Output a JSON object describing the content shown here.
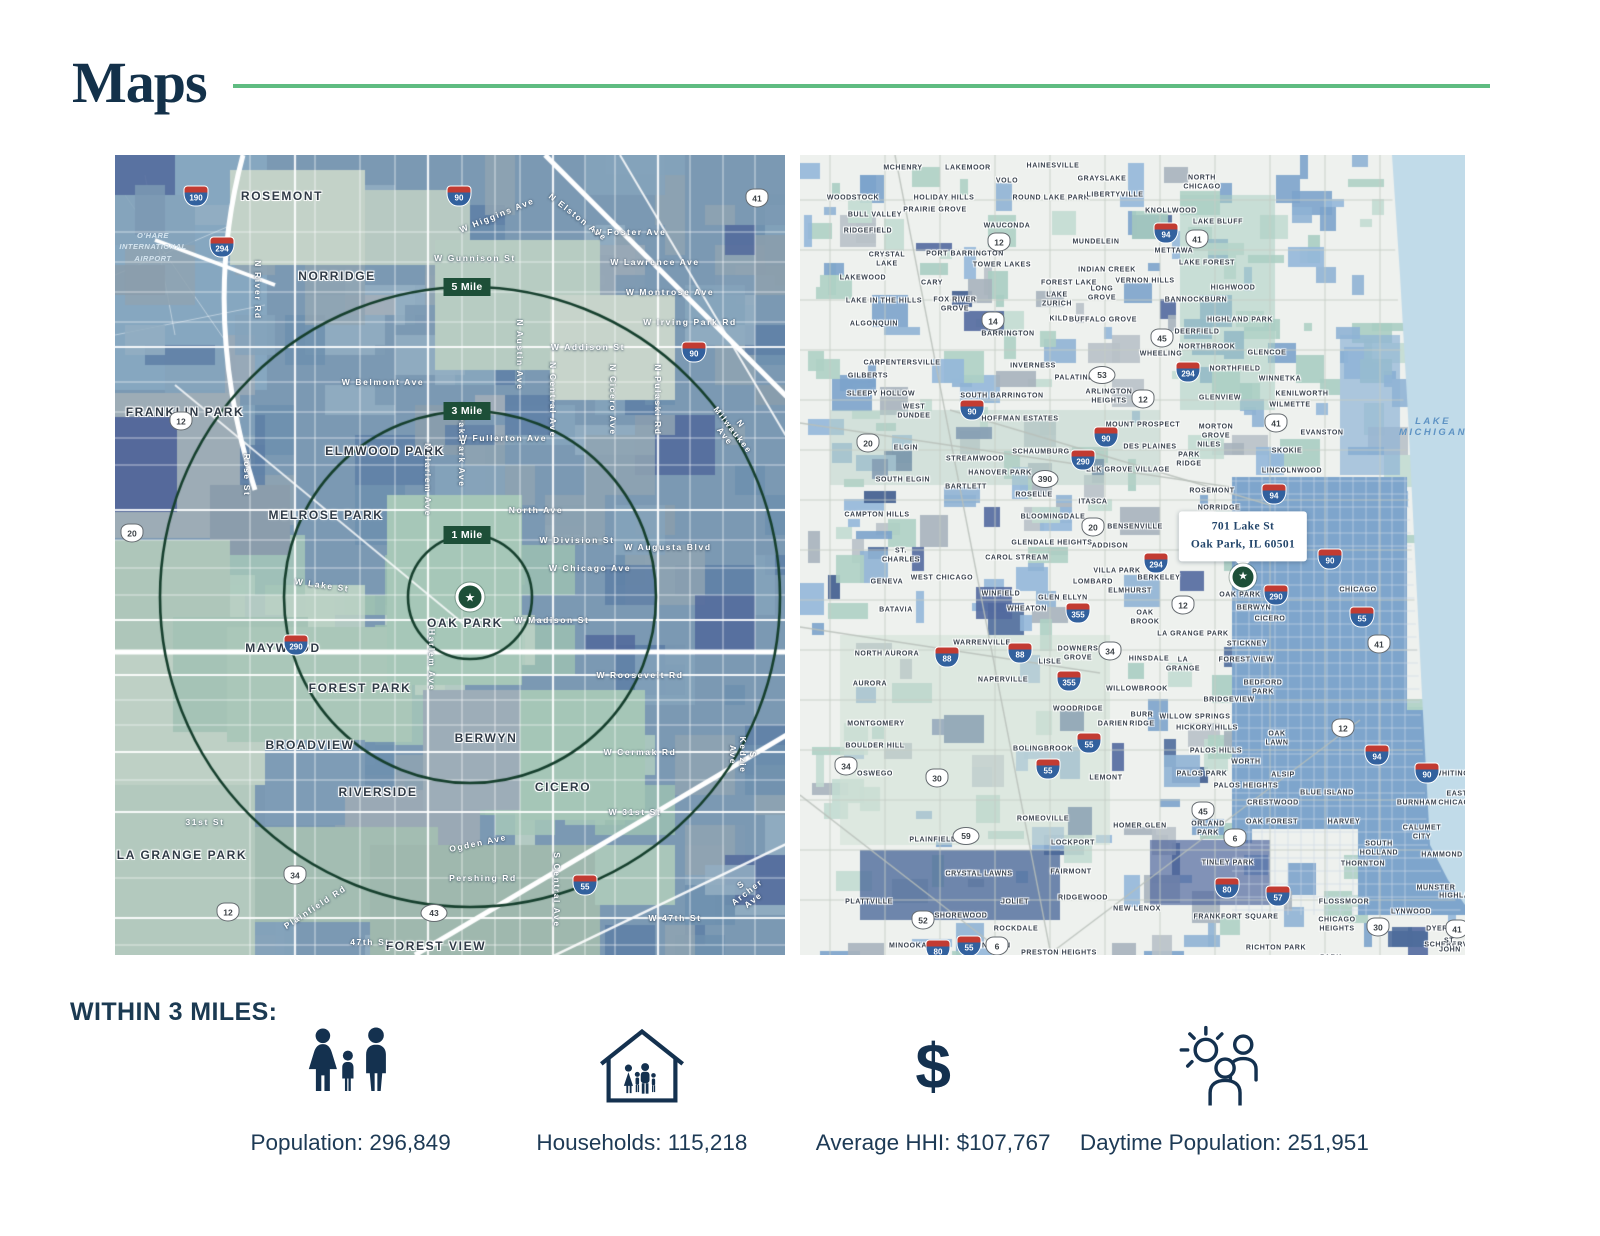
{
  "header": {
    "title": "Maps"
  },
  "icons": {
    "star": "★",
    "dollar": "$"
  },
  "colors": {
    "accent_green": "#5fbc81",
    "navy": "#14314f",
    "ring_green": "#16402e",
    "badge_green": "#1d4f38",
    "lake_blue": "#c1dbe9"
  },
  "left_map": {
    "ring_center": {
      "x": 355,
      "y": 442
    },
    "rings": [
      {
        "label": "1 Mile",
        "radius": 62
      },
      {
        "label": "3 Mile",
        "radius": 186
      },
      {
        "label": "5 Mile",
        "radius": 310
      }
    ],
    "airport_label": "O'HARE\nINTERNATIONAL\nAIRPORT",
    "airport_pos": {
      "x": 38,
      "y": 92
    },
    "cities": [
      [
        "ROSEMONT",
        167,
        41
      ],
      [
        "NORRIDGE",
        222,
        121
      ],
      [
        "FRANKLIN PARK",
        70,
        257
      ],
      [
        "ELMWOOD PARK",
        270,
        296
      ],
      [
        "MELROSE PARK",
        211,
        360
      ],
      [
        "MAYWOOD",
        168,
        493
      ],
      [
        "FOREST PARK",
        245,
        533
      ],
      [
        "BROADVIEW",
        195,
        590
      ],
      [
        "RIVERSIDE",
        263,
        637
      ],
      [
        "LA GRANGE PARK",
        67,
        700
      ],
      [
        "BERWYN",
        371,
        583
      ],
      [
        "CICERO",
        448,
        632
      ],
      [
        "FOREST VIEW",
        321,
        791
      ],
      [
        "OAK PARK",
        350,
        468
      ]
    ],
    "streets": [
      [
        "W Gunnison St",
        360,
        103,
        0
      ],
      [
        "W Foster Ave",
        515,
        77,
        0
      ],
      [
        "W Lawrence Ave",
        540,
        107,
        0
      ],
      [
        "W Montrose Ave",
        555,
        137,
        0
      ],
      [
        "W Irving Park Rd",
        575,
        167,
        0
      ],
      [
        "W Addison St",
        473,
        192,
        0
      ],
      [
        "W Belmont Ave",
        268,
        227,
        0
      ],
      [
        "W Fullerton Ave",
        388,
        283,
        0
      ],
      [
        "North Ave",
        421,
        355,
        0
      ],
      [
        "W Division St",
        462,
        385,
        0
      ],
      [
        "W Chicago Ave",
        475,
        413,
        0
      ],
      [
        "W Augusta Blvd",
        553,
        392,
        0
      ],
      [
        "W Madison St",
        437,
        465,
        0
      ],
      [
        "W Roosevelt Rd",
        525,
        520,
        0
      ],
      [
        "W Cermak Rd",
        525,
        597,
        0
      ],
      [
        "W 31st St",
        520,
        657,
        0
      ],
      [
        "W 47th St",
        560,
        763,
        0
      ],
      [
        "31st St",
        90,
        667,
        0
      ],
      [
        "Ogden Ave",
        363,
        688,
        -12
      ],
      [
        "Pershing Rd",
        368,
        723,
        0
      ],
      [
        "Plainfield Rd",
        200,
        752,
        -33
      ],
      [
        "47th St",
        255,
        787,
        0
      ],
      [
        "W Lake St",
        207,
        430,
        8
      ],
      [
        "N River Rd",
        143,
        135,
        90
      ],
      [
        "Rose St",
        132,
        320,
        90
      ],
      [
        "N Harlem Ave",
        313,
        325,
        90
      ],
      [
        "N Oak Park Ave",
        347,
        290,
        90
      ],
      [
        "N Austin Ave",
        405,
        200,
        90
      ],
      [
        "N Central Ave",
        438,
        245,
        90
      ],
      [
        "N Cicero Ave",
        498,
        245,
        90
      ],
      [
        "N Pulaski Rd",
        543,
        245,
        90
      ],
      [
        "N Milwaukee Ave",
        618,
        275,
        52
      ],
      [
        "Harlem Ave",
        317,
        505,
        90
      ],
      [
        "S Central Ave",
        442,
        735,
        90
      ],
      [
        "S Kedzie Ave",
        628,
        600,
        90
      ],
      [
        "S Archer Ave",
        632,
        737,
        -38
      ],
      [
        "W Higgins Ave",
        382,
        60,
        -22
      ],
      [
        "N Elston Ave",
        463,
        62,
        38
      ]
    ],
    "shields": [
      [
        "i",
        "190",
        81,
        41
      ],
      [
        "i",
        "90",
        344,
        41
      ],
      [
        "i",
        "294",
        107,
        92
      ],
      [
        "i",
        "90",
        579,
        197
      ],
      [
        "u",
        "12",
        66,
        266
      ],
      [
        "u",
        "20",
        17,
        378
      ],
      [
        "u",
        "41",
        642,
        43
      ],
      [
        "i",
        "290",
        181,
        490
      ],
      [
        "u",
        "34",
        180,
        720
      ],
      [
        "u",
        "12",
        113,
        757
      ],
      [
        "o",
        "43",
        319,
        758
      ],
      [
        "i",
        "55",
        470,
        730
      ]
    ]
  },
  "right_map": {
    "callout": {
      "line1": "701 Lake St",
      "line2": "Oak Park, IL 60501",
      "x": 443,
      "y": 406
    },
    "star": {
      "x": 443,
      "y": 422
    },
    "water_label": {
      "t": "LAKE MICHIGAN",
      "x": 633,
      "y": 272
    },
    "cities": [
      [
        "MCHENRY",
        103,
        13
      ],
      [
        "LAKEMOOR",
        168,
        13
      ],
      [
        "VOLO",
        207,
        26
      ],
      [
        "HAINESVILLE",
        253,
        11
      ],
      [
        "GRAYSLAKE",
        302,
        24
      ],
      [
        "NORTH\nCHICAGO",
        402,
        28
      ],
      [
        "WOODSTOCK",
        53,
        43
      ],
      [
        "HOLIDAY HILLS",
        144,
        43
      ],
      [
        "ROUND LAKE PARK",
        251,
        43
      ],
      [
        "LIBERTYVILLE",
        315,
        40
      ],
      [
        "BULL VALLEY",
        75,
        60
      ],
      [
        "PRAIRIE GROVE",
        135,
        55
      ],
      [
        "KNOLLWOOD",
        371,
        56
      ],
      [
        "RIDGEFIELD",
        68,
        76
      ],
      [
        "WAUCONDA",
        207,
        71
      ],
      [
        "LAKE BLUFF",
        418,
        67
      ],
      [
        "CRYSTAL\nLAKE",
        87,
        105
      ],
      [
        "PORT BARRINGTON",
        165,
        99
      ],
      [
        "MUNDELEIN",
        296,
        87
      ],
      [
        "METTAWA",
        374,
        96
      ],
      [
        "TOWER LAKES",
        202,
        110
      ],
      [
        "INDIAN CREEK",
        307,
        115
      ],
      [
        "LAKE FOREST",
        407,
        108
      ],
      [
        "LAKEWOOD",
        63,
        123
      ],
      [
        "CARY",
        132,
        128
      ],
      [
        "FOREST LAKE",
        269,
        128
      ],
      [
        "VERNON HILLS",
        345,
        126
      ],
      [
        "LONG\nGROVE",
        302,
        139
      ],
      [
        "HIGHWOOD",
        433,
        133
      ],
      [
        "LAKE IN THE HILLS",
        84,
        146
      ],
      [
        "FOX RIVER\nGROVE",
        155,
        150
      ],
      [
        "LAKE\nZURICH",
        257,
        145
      ],
      [
        "BANNOCKBURN",
        396,
        145
      ],
      [
        "ALGONQUIN",
        74,
        169
      ],
      [
        "KILDEER",
        267,
        164
      ],
      [
        "BUFFALO GROVE",
        303,
        165
      ],
      [
        "HIGHLAND PARK",
        440,
        165
      ],
      [
        "BARRINGTON",
        208,
        179
      ],
      [
        "DEERFIELD",
        397,
        177
      ],
      [
        "CARPENTERSVILLE",
        102,
        208
      ],
      [
        "NORTHBROOK",
        407,
        192
      ],
      [
        "WHEELING",
        361,
        199
      ],
      [
        "GILBERTS",
        68,
        221
      ],
      [
        "INVERNESS",
        233,
        211
      ],
      [
        "PALATINE",
        274,
        223
      ],
      [
        "GLENCOE",
        467,
        198
      ],
      [
        "NORTHFIELD",
        435,
        214
      ],
      [
        "WINNETKA",
        480,
        224
      ],
      [
        "KENILWORTH",
        502,
        239
      ],
      [
        "WILMETTE",
        490,
        250
      ],
      [
        "SLEEPY HOLLOW",
        81,
        239
      ],
      [
        "SOUTH BARRINGTON",
        202,
        241
      ],
      [
        "ARLINGTON\nHEIGHTS",
        309,
        242
      ],
      [
        "WEST\nDUNDEE",
        114,
        257
      ],
      [
        "HOFFMAN ESTATES",
        220,
        264
      ],
      [
        "MOUNT PROSPECT",
        343,
        270
      ],
      [
        "GLENVIEW",
        420,
        243
      ],
      [
        "EVANSTON",
        522,
        278
      ],
      [
        "ELGIN",
        106,
        293
      ],
      [
        "SCHAUMBURG",
        241,
        297
      ],
      [
        "DES PLAINES",
        350,
        292
      ],
      [
        "SKOKIE",
        487,
        296
      ],
      [
        "STREAMWOOD",
        175,
        304
      ],
      [
        "HANOVER PARK",
        200,
        318
      ],
      [
        "ELK GROVE VILLAGE",
        328,
        315
      ],
      [
        "MORTON\nGROVE",
        416,
        277
      ],
      [
        "NILES",
        409,
        290
      ],
      [
        "PARK\nRIDGE",
        389,
        305
      ],
      [
        "LINCOLNWOOD",
        492,
        316
      ],
      [
        "SOUTH ELGIN",
        103,
        325
      ],
      [
        "BARTLETT",
        166,
        332
      ],
      [
        "ROSELLE",
        234,
        340
      ],
      [
        "ITASCA",
        293,
        347
      ],
      [
        "ROSEMONT",
        412,
        336
      ],
      [
        "NORRIDGE",
        419,
        353
      ],
      [
        "CAMPTON HILLS",
        77,
        360
      ],
      [
        "BLOOMINGDALE",
        253,
        362
      ],
      [
        "BENSENVILLE",
        335,
        372
      ],
      [
        "ST.\nCHARLES",
        101,
        401
      ],
      [
        "GLENDALE HEIGHTS",
        252,
        388
      ],
      [
        "ADDISON",
        310,
        391
      ],
      [
        "CAROL STREAM",
        217,
        403
      ],
      [
        "VILLA PARK",
        317,
        416
      ],
      [
        "BERKELEY",
        359,
        423
      ],
      [
        "GENEVA",
        87,
        427
      ],
      [
        "WEST CHICAGO",
        142,
        423
      ],
      [
        "LOMBARD",
        293,
        427
      ],
      [
        "ELMHURST",
        330,
        436
      ],
      [
        "CHICAGO",
        558,
        435
      ],
      [
        "WINFIELD",
        201,
        439
      ],
      [
        "GLEN ELLYN",
        263,
        443
      ],
      [
        "OAK PARK",
        440,
        440
      ],
      [
        "BATAVIA",
        96,
        455
      ],
      [
        "WHEATON",
        227,
        454
      ],
      [
        "BERWYN",
        454,
        453
      ],
      [
        "CICERO",
        470,
        464
      ],
      [
        "OAK\nBROOK",
        345,
        463
      ],
      [
        "LA GRANGE PARK",
        393,
        479
      ],
      [
        "WARRENVILLE",
        182,
        488
      ],
      [
        "STICKNEY",
        447,
        489
      ],
      [
        "DOWNERS\nGROVE",
        278,
        499
      ],
      [
        "NORTH AURORA",
        87,
        499
      ],
      [
        "LISLE",
        250,
        507
      ],
      [
        "HINSDALE",
        349,
        504
      ],
      [
        "FOREST VIEW",
        446,
        505
      ],
      [
        "LA\nGRANGE",
        383,
        510
      ],
      [
        "AURORA",
        70,
        529
      ],
      [
        "NAPERVILLE",
        203,
        525
      ],
      [
        "WILLOWBROOK",
        337,
        534
      ],
      [
        "BEDFORD\nPARK",
        463,
        533
      ],
      [
        "BRIDGEVIEW",
        429,
        545
      ],
      [
        "WOODRIDGE",
        278,
        554
      ],
      [
        "BURR\nRIDGE",
        342,
        565
      ],
      [
        "DARIEN",
        313,
        569
      ],
      [
        "WILLOW SPRINGS",
        395,
        562
      ],
      [
        "HICKORY HILLS",
        407,
        573
      ],
      [
        "MONTGOMERY",
        76,
        569
      ],
      [
        "OAK\nLAWN",
        477,
        584
      ],
      [
        "BOULDER HILL",
        75,
        591
      ],
      [
        "BOLINGBROOK",
        243,
        594
      ],
      [
        "PALOS HILLS",
        416,
        596
      ],
      [
        "WORTH",
        446,
        607
      ],
      [
        "WHITING",
        652,
        619
      ],
      [
        "OSWEGO",
        75,
        619
      ],
      [
        "LEMONT",
        306,
        623
      ],
      [
        "PALOS PARK",
        402,
        619
      ],
      [
        "ALSIP",
        483,
        620
      ],
      [
        "PALOS HEIGHTS",
        446,
        631
      ],
      [
        "BLUE ISLAND",
        527,
        638
      ],
      [
        "CRESTWOOD",
        473,
        648
      ],
      [
        "BURNHAM",
        617,
        648
      ],
      [
        "EAST\nCHICAGO",
        657,
        644
      ],
      [
        "ORLAND\nPARK",
        408,
        674
      ],
      [
        "OAK FOREST",
        472,
        667
      ],
      [
        "HARVEY",
        544,
        667
      ],
      [
        "CALUMET\nCITY",
        622,
        678
      ],
      [
        "ROMEOVILLE",
        243,
        664
      ],
      [
        "HOMER GLEN",
        340,
        671
      ],
      [
        "SOUTH\nHOLLAND",
        579,
        694
      ],
      [
        "PLAINFIELD",
        133,
        685
      ],
      [
        "LOCKPORT",
        273,
        688
      ],
      [
        "TINLEY PARK",
        428,
        708
      ],
      [
        "THORNTON",
        563,
        709
      ],
      [
        "HAMMOND",
        642,
        700
      ],
      [
        "CRYSTAL LAWNS",
        179,
        719
      ],
      [
        "FAIRMONT",
        271,
        717
      ],
      [
        "MUNSTER",
        636,
        733
      ],
      [
        "HIGHLAND",
        660,
        741
      ],
      [
        "PLATTVILLE",
        69,
        747
      ],
      [
        "JOLIET",
        215,
        747
      ],
      [
        "RIDGEWOOD",
        283,
        743
      ],
      [
        "NEW LENOX",
        337,
        754
      ],
      [
        "FLOSSMOOR",
        544,
        747
      ],
      [
        "LYNWOOD",
        611,
        757
      ],
      [
        "SHOREWOOD",
        161,
        761
      ],
      [
        "FRANKFORT SQUARE",
        436,
        762
      ],
      [
        "CHICAGO\nHEIGHTS",
        537,
        770
      ],
      [
        "DYER",
        637,
        774
      ],
      [
        "ROCKDALE",
        216,
        774
      ],
      [
        "SCHERERVILLE",
        655,
        790
      ],
      [
        "RICHTON PARK",
        476,
        793
      ],
      [
        "PRESTON HEIGHTS",
        259,
        798
      ],
      [
        "PARK\nFOREST",
        531,
        808
      ],
      [
        "MINOOKA",
        108,
        791
      ],
      [
        "CHANNAHON",
        185,
        791
      ],
      [
        "ST. JOHN",
        650,
        791
      ]
    ],
    "shields": [
      [
        "i",
        "94",
        366,
        78
      ],
      [
        "u",
        "41",
        397,
        84
      ],
      [
        "u",
        "12",
        199,
        87
      ],
      [
        "u",
        "14",
        193,
        166
      ],
      [
        "o",
        "53",
        302,
        220
      ],
      [
        "u",
        "45",
        362,
        183
      ],
      [
        "i",
        "294",
        388,
        217
      ],
      [
        "u",
        "12",
        343,
        244
      ],
      [
        "i",
        "90",
        172,
        255
      ],
      [
        "u",
        "20",
        68,
        288
      ],
      [
        "i",
        "90",
        306,
        282
      ],
      [
        "i",
        "290",
        283,
        305
      ],
      [
        "o",
        "390",
        245,
        324
      ],
      [
        "u",
        "20",
        293,
        372
      ],
      [
        "i",
        "294",
        356,
        408
      ],
      [
        "u",
        "41",
        476,
        268
      ],
      [
        "i",
        "94",
        474,
        339
      ],
      [
        "i",
        "90",
        530,
        404
      ],
      [
        "u",
        "12",
        383,
        450
      ],
      [
        "i",
        "290",
        476,
        440
      ],
      [
        "i",
        "55",
        562,
        462
      ],
      [
        "u",
        "41",
        579,
        489
      ],
      [
        "i",
        "88",
        147,
        502
      ],
      [
        "i",
        "88",
        220,
        498
      ],
      [
        "u",
        "34",
        310,
        496
      ],
      [
        "i",
        "355",
        278,
        458
      ],
      [
        "i",
        "355",
        269,
        526
      ],
      [
        "u",
        "12",
        543,
        573
      ],
      [
        "i",
        "55",
        289,
        588
      ],
      [
        "i",
        "94",
        577,
        600
      ],
      [
        "u",
        "34",
        46,
        611
      ],
      [
        "i",
        "55",
        248,
        614
      ],
      [
        "i",
        "90",
        627,
        618
      ],
      [
        "u",
        "30",
        137,
        623
      ],
      [
        "u",
        "45",
        403,
        656
      ],
      [
        "o",
        "59",
        166,
        681
      ],
      [
        "u",
        "6",
        435,
        683
      ],
      [
        "i",
        "80",
        427,
        733
      ],
      [
        "i",
        "57",
        478,
        741
      ],
      [
        "u",
        "52",
        123,
        765
      ],
      [
        "u",
        "6",
        197,
        791
      ],
      [
        "i",
        "55",
        169,
        791
      ],
      [
        "i",
        "80",
        138,
        795
      ],
      [
        "u",
        "30",
        578,
        772
      ],
      [
        "u",
        "41",
        657,
        774
      ]
    ]
  },
  "stats": {
    "heading": "WITHIN 3 MILES:",
    "items": [
      {
        "icon": "population-family-icon",
        "label": "Population: 296,849"
      },
      {
        "icon": "households-house-icon",
        "label": "Households: 115,218"
      },
      {
        "icon": "average-hhi-dollar-icon",
        "label": "Average HHI: $107,767"
      },
      {
        "icon": "daytime-population-icon",
        "label": "Daytime Population: 251,951"
      }
    ]
  }
}
